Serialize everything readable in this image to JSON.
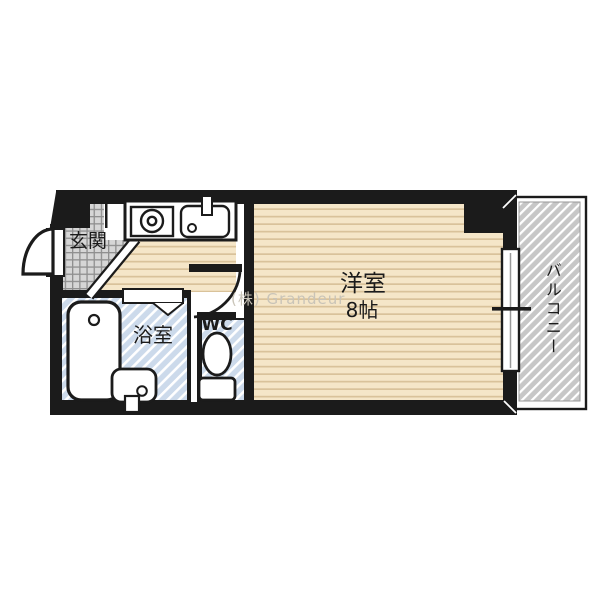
{
  "floorplan": {
    "type": "apartment-floor-plan",
    "labels": {
      "entrance": "玄関",
      "bathroom": "浴室",
      "wc": "WC",
      "main_room": "洋室",
      "main_room_size": "8帖",
      "balcony": "バルコニー"
    },
    "watermark": "(株) Grandeur",
    "colors": {
      "wall": "#1b1b1b",
      "wood_floor": "#f5e6c8",
      "wood_stripe": "#d9c29a",
      "tile_floor": "#d6d6d6",
      "tile_grid": "#8f8f8f",
      "wet_area_hatch": "#ccdaeb",
      "balcony_hatch": "#c7c7c7",
      "fixture_fill": "#ffffff",
      "watermark": "#c9c4b8"
    },
    "fixtures": [
      "stove-icon",
      "sink-icon",
      "faucet-icon",
      "bathtub-icon",
      "washbasin-icon",
      "toilet-icon",
      "entrance-door-icon",
      "room-door-icon",
      "folding-door-icon",
      "sliding-window-icon",
      "window-center-mark-icon"
    ]
  }
}
